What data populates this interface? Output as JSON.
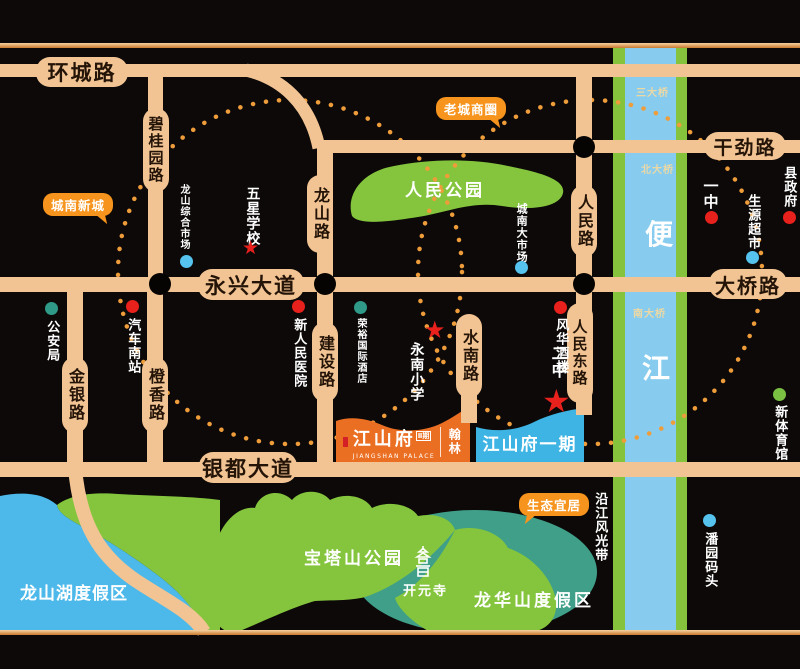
{
  "roads": {
    "huancheng": "环城路",
    "biguiyuan": "碧桂园路",
    "longshan": "龙山路",
    "ganjin": "干劲路",
    "yongxing": "永兴大道",
    "daqiao": "大桥路",
    "renmin": "人民路",
    "renmindong": "人民东路",
    "shuinan": "水南路",
    "jianshe": "建设路",
    "chengxiang": "橙香路",
    "jinyin": "金银路",
    "yindu": "银都大道"
  },
  "river": {
    "name_top": "便",
    "name_bottom": "江",
    "bridge_3rd": "三大桥",
    "bridge_north": "北大桥",
    "bridge_south": "南大桥"
  },
  "areas": {
    "renmin_park": "人民公园",
    "baota_park": "宝塔山公园",
    "longshanhu_resort": "龙山湖度假区",
    "longhuashan_resort": "龙华山度假区",
    "riverside_belt": "沿江风光带",
    "kaiyuan_temple": "开元寺"
  },
  "callouts": {
    "chengnan_xincheng": "城南新城",
    "laocheng_shangquan": "老城商圈",
    "shengtai_yiju": "生态宜居"
  },
  "pois": {
    "longshan_market": "龙山综合市场",
    "wuxing_school": "五星学校",
    "chengnan_market": "城南大市场",
    "gongan_bureau": "公安局",
    "qiche_south_station": "汽车南站",
    "xin_renmin_hospital": "新人民医院",
    "rongyu_hotel": "荣裕国际酒店",
    "fenghua_restaurant": "风华酒楼",
    "yongnan_school": "永南小学",
    "no2_middle_school": "二中",
    "no1_middle_school": "一中",
    "county_gov": "县政府",
    "shengyuan_market": "生源超市",
    "new_gym": "新体育馆",
    "panyuan_wharf": "潘园码头"
  },
  "markers": {
    "star_glyph": "★"
  },
  "project": {
    "name": "江山府",
    "phase_tag": "Ⅱ期",
    "name_en": "JIANGSHAN PALACE",
    "brand": "翰林",
    "phase1_label": "江山府一期"
  },
  "colors": {
    "background": "#0c0908",
    "road": "#f2c493",
    "road_text": "#241408",
    "river_blue": "#87ccee",
    "river_bank_green": "#86c33c",
    "park_green": "#84c53d",
    "resort_teal": "#3f9f88",
    "lake_blue": "#4cb9ea",
    "callout_orange": "#f7941d",
    "project_orange": "#eb6f23",
    "project_blue": "#3db4e4",
    "marker_red": "#e8211d",
    "marker_blue": "#56c2ee",
    "marker_teal": "#2f9a88",
    "marker_green": "#7ac143",
    "ring_dot_orange": "#ef9c3a"
  }
}
